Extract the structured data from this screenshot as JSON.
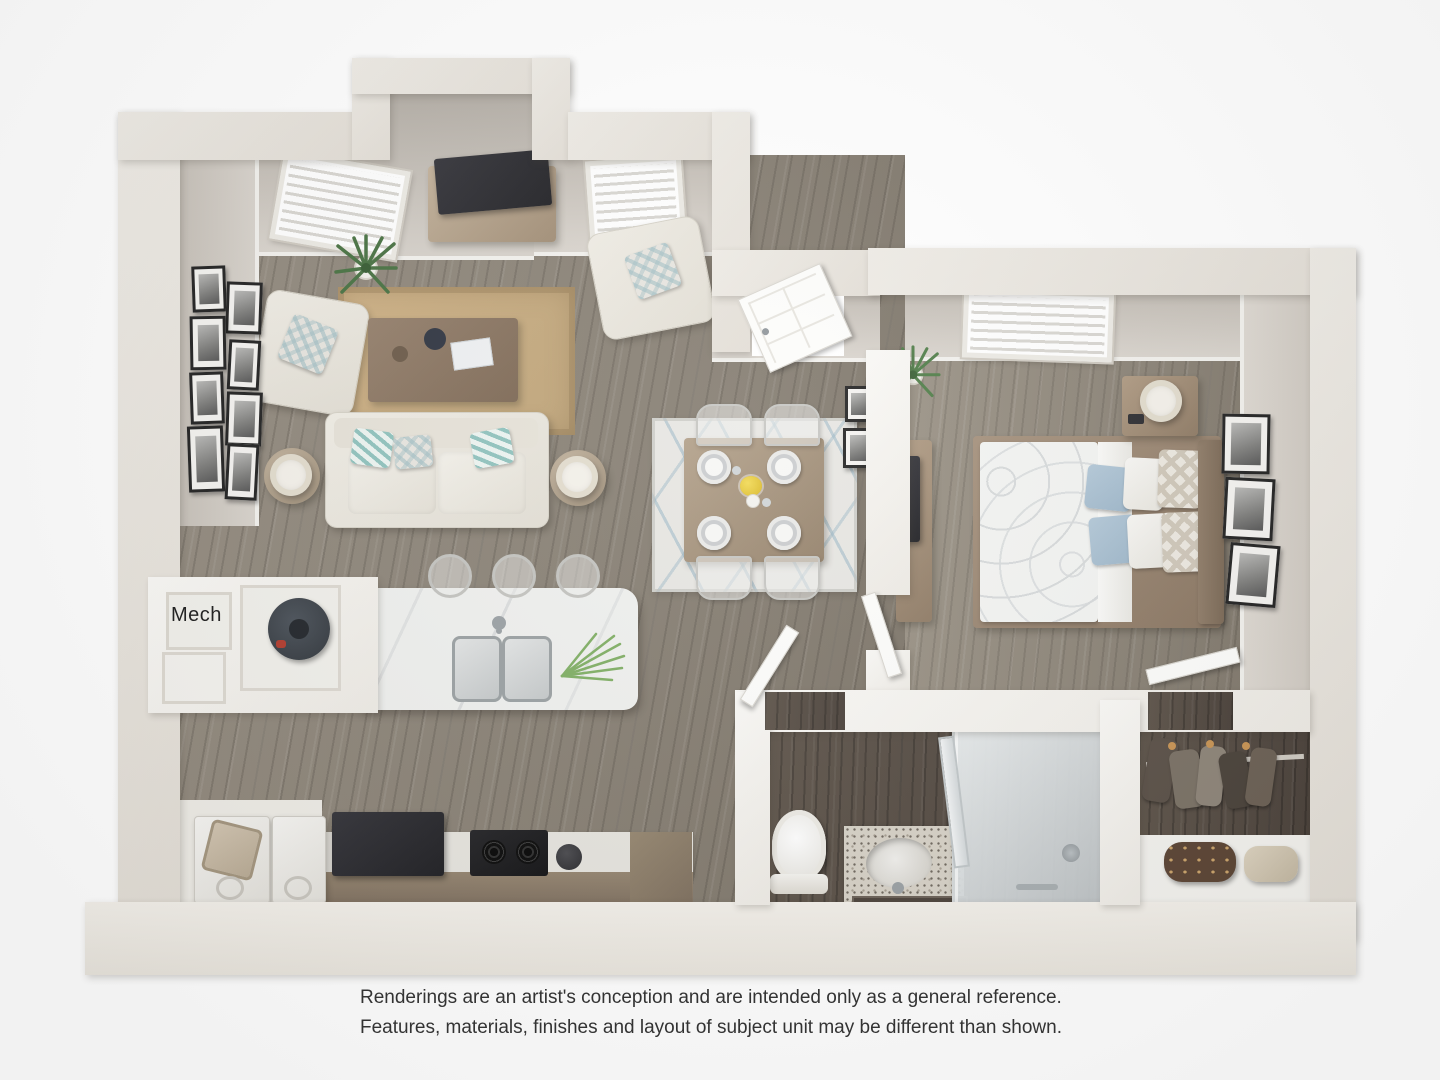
{
  "labels": {
    "mech": "Mech"
  },
  "disclaimer": {
    "line1": "Renderings are an artist's conception and are intended only as a general reference.",
    "line2": "Features, materials, finishes and layout of subject unit may be different than shown."
  },
  "palette": {
    "background": "#ffffff",
    "outer_wall": "#e9e5de",
    "interior_wall_face": "#cfc9c1",
    "white_partition": "#f8f7f4",
    "wood_floor": "#8a8276",
    "bedroom_floor": "#8f887c",
    "dark_bath_floor": "#574d43",
    "jute_rug": "#c6aa7e",
    "dining_rug": "#e7e6e2",
    "dining_rug_pattern": "#9cb9c7",
    "upholstery_cream": "#ece9e1",
    "wood_furniture": "#a08b74",
    "marble_counter": "#eff0ee",
    "cabinet_front": "#8c7d6c",
    "appliance_dark": "#26262a",
    "teal_pillow": "#8fc2bd",
    "blue_bed_pillow": "#a9c1d3",
    "plant_green": "#477141",
    "flower_yellow": "#e8c832",
    "disclaimer_text": "#333333"
  },
  "scene": {
    "type": "3d-floor-plan-rendering",
    "rooms": [
      "living-room",
      "dining-area",
      "kitchen",
      "laundry-nook",
      "mechanical-closet",
      "entry",
      "bedroom",
      "bathroom",
      "walk-in-closet"
    ]
  }
}
